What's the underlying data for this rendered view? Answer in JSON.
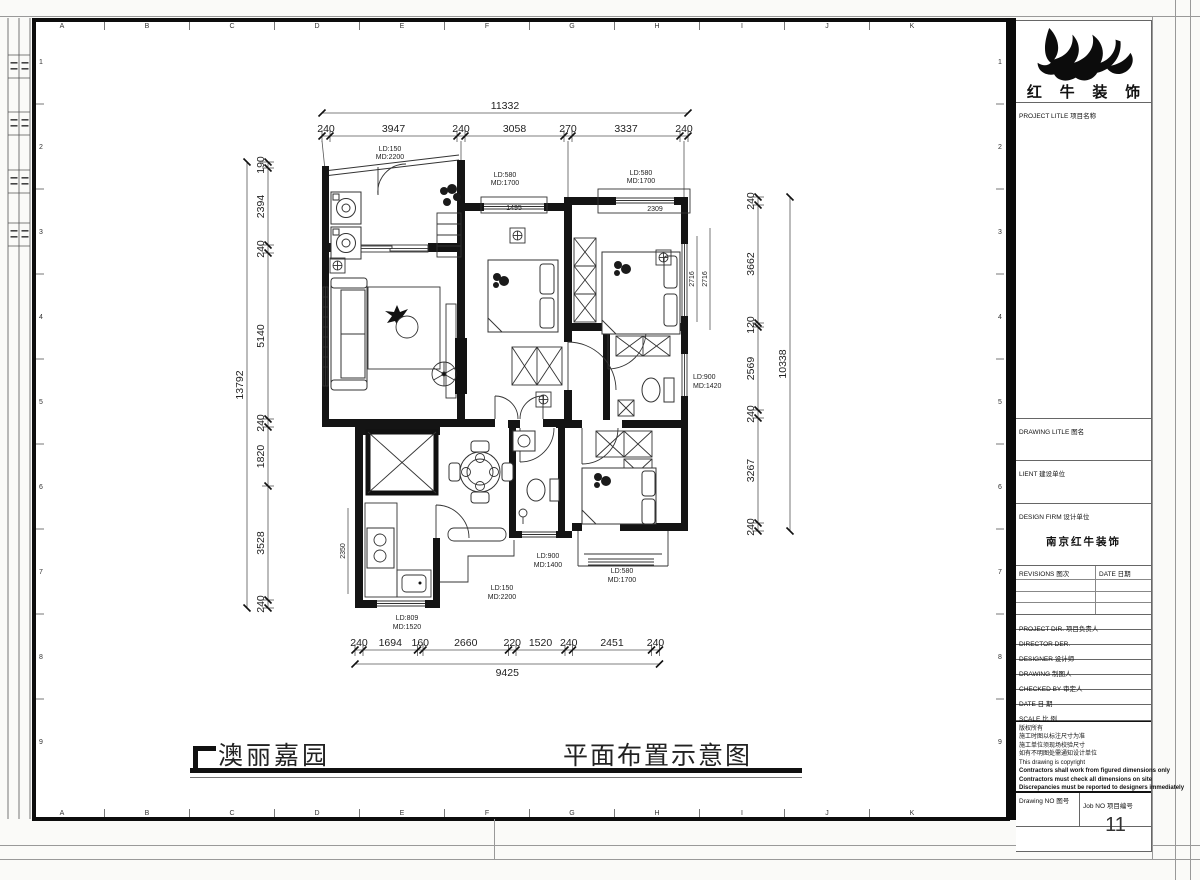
{
  "sheet": {
    "col_letters": [
      "A",
      "B",
      "C",
      "D",
      "E",
      "F",
      "G",
      "H",
      "I",
      "J",
      "K"
    ],
    "row_numbers": [
      "1",
      "2",
      "3",
      "4",
      "5",
      "6",
      "7",
      "8",
      "9"
    ]
  },
  "plan": {
    "dims": {
      "top_total": "11332",
      "top": [
        "240",
        "3947",
        "240",
        "3058",
        "270",
        "3337",
        "240"
      ],
      "left_total": "13792",
      "left": [
        "190",
        "2394",
        "240",
        "5140",
        "240",
        "1820",
        "3528",
        "240"
      ],
      "right_total": "10338",
      "right": [
        "240",
        "3662",
        "120",
        "2569",
        "240",
        "3267",
        "240"
      ],
      "bottom_total": "9425",
      "bottom": [
        "240",
        "1694",
        "160",
        "2660",
        "220",
        "1520",
        "240",
        "2451",
        "240"
      ],
      "win_bed1": "1495",
      "win_bed2": "2309",
      "win_side_a": "2716",
      "win_side_b": "2716",
      "kitchen_depth": "2350"
    },
    "openings": {
      "entry": [
        "LD:150",
        "MD:2200"
      ],
      "bed1_window": [
        "LD:580",
        "MD:1700"
      ],
      "bed2_window": [
        "LD:580",
        "MD:1700"
      ],
      "bath_right_window": [
        "LD:900",
        "MD:1420"
      ],
      "bath_center_window": [
        "LD:900",
        "MD:1400"
      ],
      "hall_window": [
        "LD:150",
        "MD:2200"
      ],
      "kitchen_window": [
        "LD:809",
        "MD:1520"
      ],
      "bed3_window": [
        "LD:580",
        "MD:1700"
      ]
    }
  },
  "footer": {
    "project_name": "澳丽嘉园",
    "drawing_title": "平面布置示意图"
  },
  "title_block": {
    "brand": "红 牛 装 饰",
    "project_title": "PROJECT LITLE  项目名称",
    "drawing_title": "DRAWING LITLE  图名",
    "client": "LIENT  建设单位",
    "design_firm": "DESIGN FIRM  设计单位",
    "design_firm_value": "南京红牛装饰",
    "revisions": "REVISIONS  图次",
    "rev_date": "DATE  日期",
    "project_dir": "PROJECT DIR.  项目负责人",
    "director": "DIRECTOR DER.",
    "designer": "DESIGNER  设计师",
    "drawing_by": "DRAWING  制图人",
    "checked_by": "CHECKED BY  审定人",
    "date": "DATE  日 期",
    "scale": "SCALE  比 例",
    "notes": [
      "版权所有",
      "施工时图以标注尺寸为准",
      "施工单位须现场校验尺寸",
      "如有不明图处需通知设计单位",
      "This drawing is copyright",
      "Contractors shall work from figured dimensions only",
      "Contractors must check all dimensions on site",
      "Discrepancies must be reported to designers immediately"
    ],
    "drawing_no": "Drawing NO  图号",
    "job_no": "Job NO  项目编号",
    "job_no_value": "11"
  }
}
